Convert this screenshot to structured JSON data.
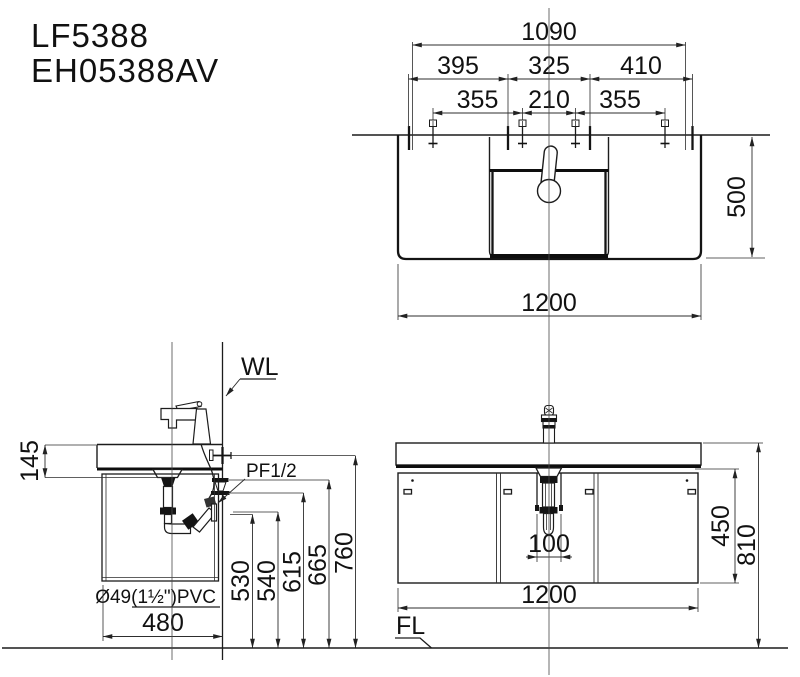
{
  "title": {
    "model_1": "LF5388",
    "model_2": "EH05388AV"
  },
  "top_view": {
    "dim_1090": "1090",
    "dim_395": "395",
    "dim_325": "325",
    "dim_410": "410",
    "dim_355_left": "355",
    "dim_210": "210",
    "dim_355_right": "355",
    "dim_500": "500",
    "dim_1200": "1200"
  },
  "side_view": {
    "label_wall_line": "WL",
    "label_supply": "PF1/2",
    "label_drain_pipe": "Ø49(1½\")PVC",
    "dim_145": "145",
    "dim_530": "530",
    "dim_540": "540",
    "dim_615": "615",
    "dim_665": "665",
    "dim_760": "760",
    "dim_480": "480"
  },
  "front_view": {
    "label_floor_line": "FL",
    "dim_100": "100",
    "dim_450": "450",
    "dim_810": "810",
    "dim_1200": "1200"
  }
}
